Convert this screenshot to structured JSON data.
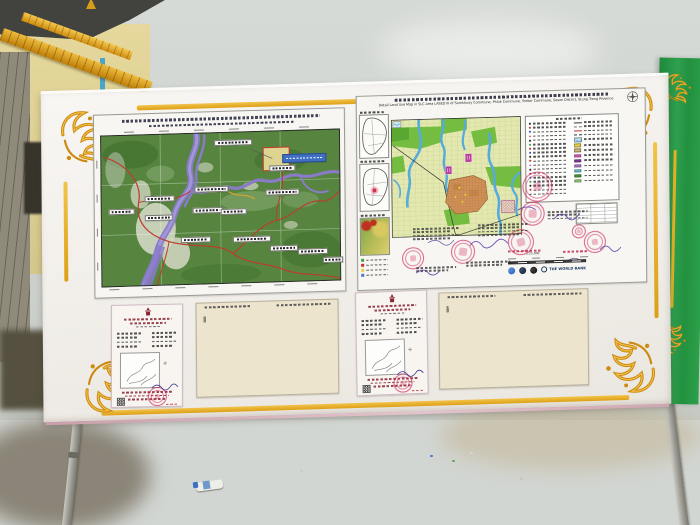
{
  "texts": {
    "right_map_title_en": "Detail Land Use Map in SLC Area LASED III of Samkhuoy Commune, Phluk Commune, Srekor Commune, Sesan District, Stung Treng Province",
    "world_bank": "THE WORLD BANK",
    "program_code": "LASED III",
    "scale_note": "1:25,000"
  },
  "icons": {
    "compass_rose": "compass-rose",
    "north_cross": "✛",
    "world_bank_globe": "◍"
  },
  "colors": {
    "sky": "#d2d6d2",
    "ground": "#8d7a5b",
    "board_white": "#f4f2ee",
    "gold_trim": "#e0a81e",
    "banner_green": "#2e9c49",
    "forest_green": "#57853f",
    "river_purple": "#8a7bc9",
    "road_red": "#bd3b2b",
    "slc_highlight": "#ddd491",
    "landuse_base": "#e2e8ae",
    "landuse_green": "#74bd40",
    "stream_blue": "#55abdc",
    "village_orange": "#d09158",
    "special_magenta": "#ba3a9e",
    "stamp_red": "#cd235a",
    "signature_purple": "#5b3fae",
    "certificate_maroon": "#8a2433",
    "paper_cream": "#ece4cd"
  },
  "legend": {
    "left_rows": 18,
    "left_dot_colors": [
      "#222222",
      "#c03030",
      "#3050c0",
      "#c03030",
      "#222222",
      "#2f9e44",
      "#c03030",
      "#3050c0",
      "#222222",
      "#c03030",
      "#a030a0",
      "#222222",
      "#c03030",
      "#3050c0",
      "#2f9e44",
      "#222222",
      "#c03030",
      "#222222"
    ],
    "line_symbols": [
      "#333333",
      "#777777",
      "#c03030",
      "#333333"
    ],
    "patch_colors": [
      "#e8d44d",
      "#cdb97c",
      "#e565c8",
      "#8e3fa8",
      "#b583d6",
      "#6fc9e2",
      "#4f9f3f",
      "#a5d687"
    ],
    "water_chip": "#bfe2f2"
  },
  "left_map": {
    "label_count": 15,
    "coordinate_ticks_top": 6,
    "coordinate_ticks_bottom": 7
  },
  "right_map": {
    "inset_count": 3,
    "stamp_count": 7,
    "logos": [
      "blue-round-logo",
      "dark-round-logo",
      "dark-round-logo",
      "world-bank-logo"
    ]
  },
  "documents": {
    "certificates": 2,
    "tables": 2,
    "table_columns": 7,
    "table_empty_rows": 12
  }
}
